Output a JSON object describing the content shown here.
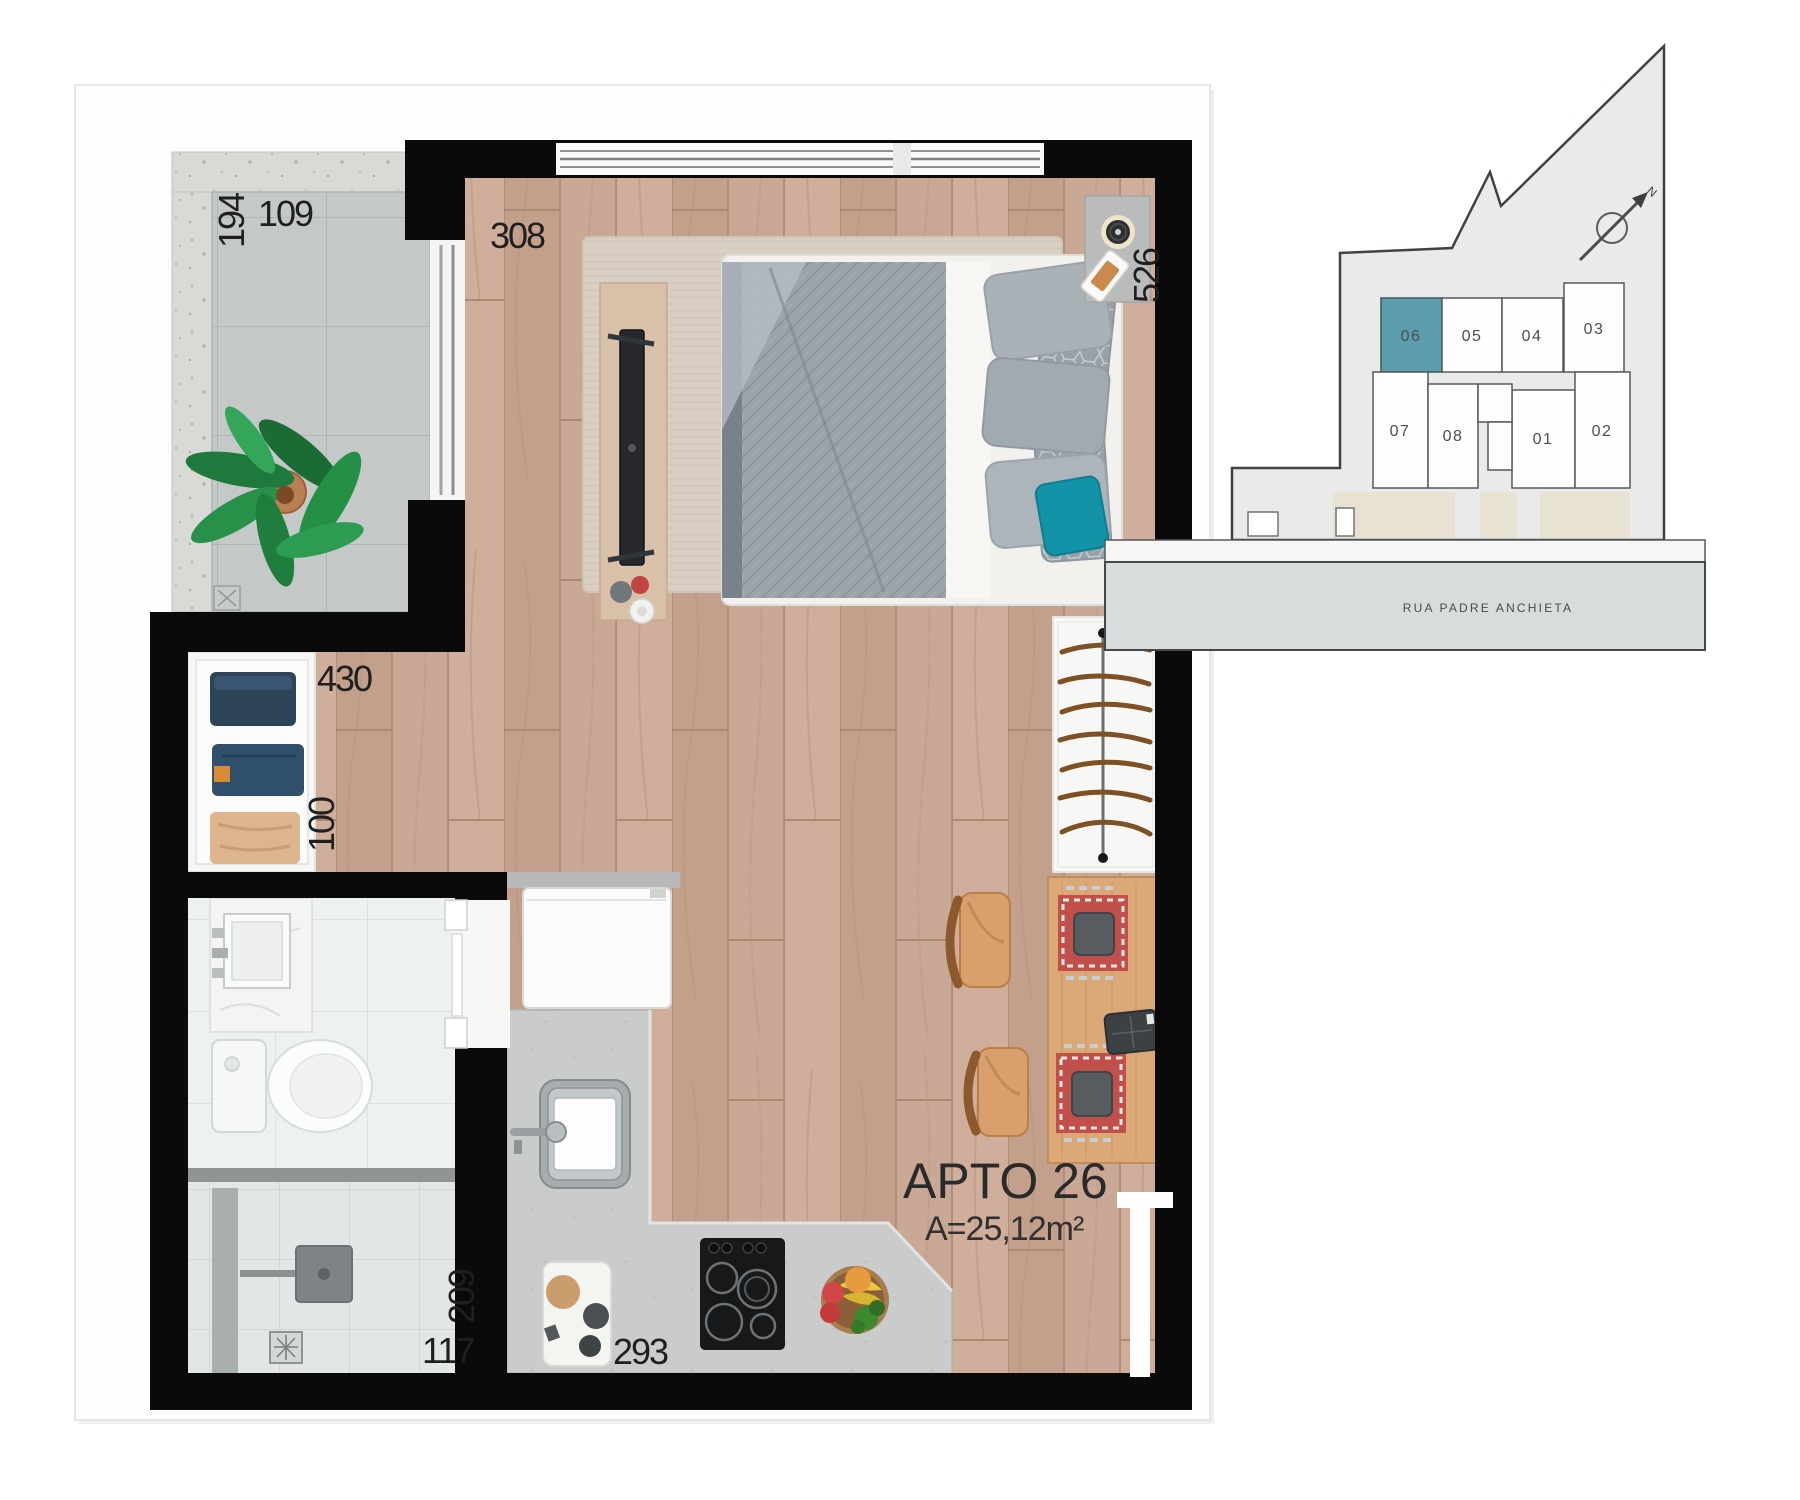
{
  "page": {
    "background": "#ffffff"
  },
  "floor_plan": {
    "unit_title": "APTO 26",
    "unit_area": "A=25,12m²",
    "dimensions": {
      "balcony_length": "194",
      "balcony_width": "109",
      "living_width": "308",
      "bed_wall_length": "526",
      "closet_wall_width": "430",
      "closet_depth": "100",
      "shower_length": "209",
      "shower_width": "117",
      "kitchen_counter_width": "293"
    }
  },
  "key_map": {
    "street_label": "RUA PADRE ANCHIETA",
    "north_label": "N",
    "highlight_color": "#5b9dac",
    "units": [
      {
        "label": "06",
        "highlighted": true
      },
      {
        "label": "05",
        "highlighted": false
      },
      {
        "label": "04",
        "highlighted": false
      },
      {
        "label": "03",
        "highlighted": false
      },
      {
        "label": "07",
        "highlighted": false
      },
      {
        "label": "08",
        "highlighted": false
      },
      {
        "label": "01",
        "highlighted": false
      },
      {
        "label": "02",
        "highlighted": false
      }
    ]
  },
  "colors": {
    "walls": "#0a0a0a",
    "wood_floor": "#c9a895",
    "rug": "#d9d0c3",
    "balcony_tile": "#c4c8c7",
    "concrete": "#d9d9d5",
    "counter": "#c9ccca",
    "accent_pillow": "#1393a8",
    "footprint": "#e9eae9",
    "street": "#d9dcdc",
    "sidewalk": "#e7e2d2"
  }
}
